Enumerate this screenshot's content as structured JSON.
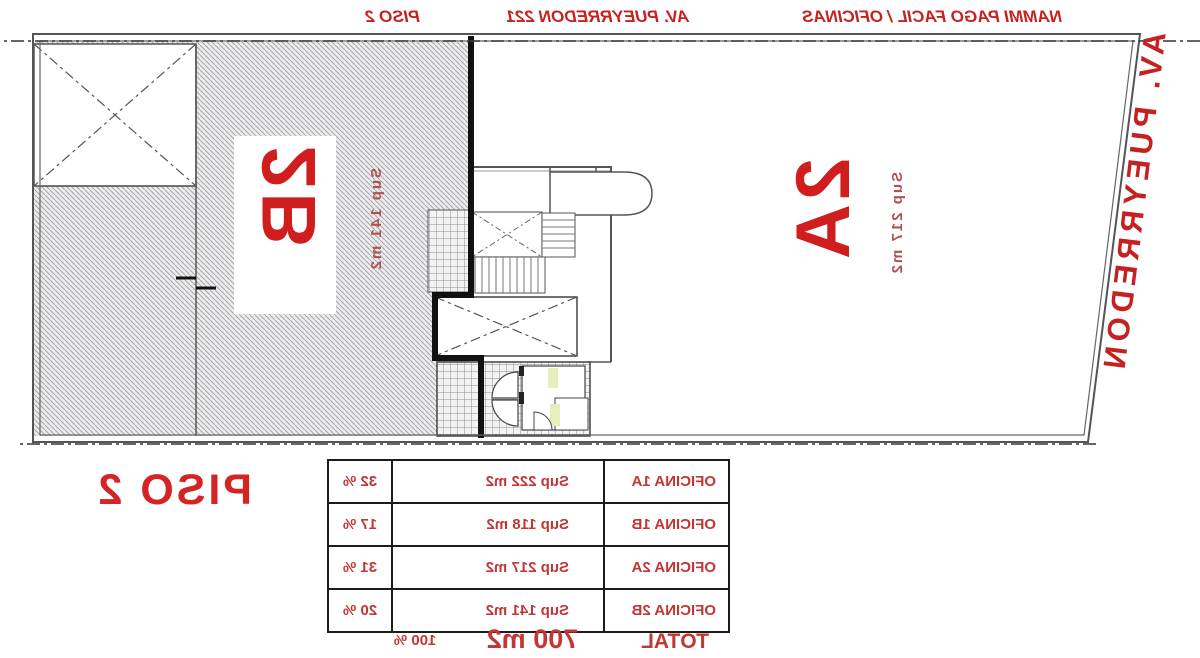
{
  "title_bar": {
    "left": "NAMMI PAGO FACIL / OFICINAS",
    "center": "AV. PUEYRREDON 221",
    "right": "PISO 2"
  },
  "street_label": "AV. PUEYRREDON",
  "floor_label": "PISO 2",
  "units": {
    "unit_2a": {
      "name": "2A",
      "sup": "Sup 217 m2"
    },
    "unit_2b": {
      "name": "2B",
      "sup": "Sup 141 m2"
    }
  },
  "table": {
    "rows": [
      {
        "name": "OFICINA 1A",
        "sup": "Sup 222 m2",
        "pct": "32 %"
      },
      {
        "name": "OFICINA 1B",
        "sup": "Sup 118 m2",
        "pct": "17 %"
      },
      {
        "name": "OFICINA 2A",
        "sup": "Sup 217 m2",
        "pct": "31 %"
      },
      {
        "name": "OFICINA 2B",
        "sup": "Sup 141 m2",
        "pct": "20 %"
      }
    ],
    "total": {
      "name": "TOTAL",
      "sup": "700 m2",
      "pct": "100 %"
    }
  },
  "colors": {
    "accent_red": "#c62020",
    "label_red": "#d01d1d",
    "sup_red": "#b05252",
    "table_red": "#c33636",
    "wall_gray": "#555555",
    "thick_wall": "#111111",
    "hatch_line": "#a6a6ae",
    "hatch_bg": "#ececec",
    "door_highlight": "#e7eebc"
  }
}
